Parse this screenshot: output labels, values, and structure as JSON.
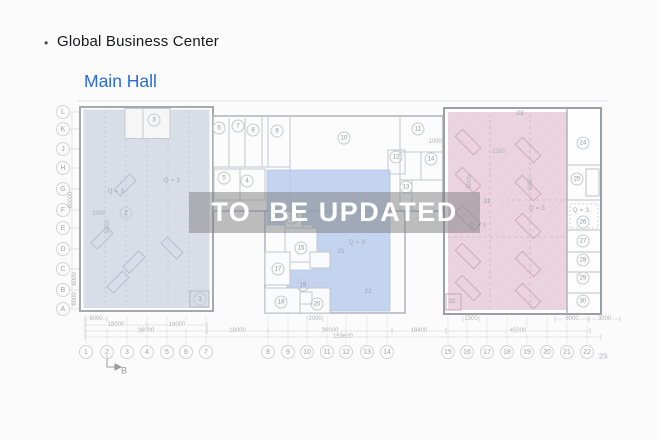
{
  "header": {
    "bullet": "•",
    "title": "Global Business Center",
    "subtitle": "Main Hall"
  },
  "watermark": "TO  BE UPDATED",
  "grid": {
    "rows": [
      {
        "label": "L",
        "y": 112
      },
      {
        "label": "K",
        "y": 129
      },
      {
        "label": "J",
        "y": 149
      },
      {
        "label": "H",
        "y": 168
      },
      {
        "label": "G",
        "y": 189
      },
      {
        "label": "F",
        "y": 210
      },
      {
        "label": "E",
        "y": 228
      },
      {
        "label": "D",
        "y": 249
      },
      {
        "label": "C",
        "y": 269
      },
      {
        "label": "B",
        "y": 290
      },
      {
        "label": "A",
        "y": 309
      }
    ],
    "cols": [
      {
        "label": "1",
        "x": 86
      },
      {
        "label": "2",
        "x": 107
      },
      {
        "label": "3",
        "x": 127
      },
      {
        "label": "4",
        "x": 147
      },
      {
        "label": "5",
        "x": 167
      },
      {
        "label": "6",
        "x": 186
      },
      {
        "label": "7",
        "x": 206
      },
      {
        "label": "8",
        "x": 268
      },
      {
        "label": "9",
        "x": 288
      },
      {
        "label": "10",
        "x": 307
      },
      {
        "label": "11",
        "x": 327
      },
      {
        "label": "12",
        "x": 346
      },
      {
        "label": "13",
        "x": 367
      },
      {
        "label": "14",
        "x": 387
      },
      {
        "label": "15",
        "x": 448
      },
      {
        "label": "16",
        "x": 467
      },
      {
        "label": "17",
        "x": 487
      },
      {
        "label": "18",
        "x": 507
      },
      {
        "label": "19",
        "x": 527
      },
      {
        "label": "20",
        "x": 547
      },
      {
        "label": "21",
        "x": 567
      },
      {
        "label": "22",
        "x": 587
      }
    ],
    "cols_y": 352,
    "col_offset": {
      "label": "23",
      "x": 603,
      "y": 356
    }
  },
  "rooms": {
    "circled": [
      {
        "n": "1",
        "x": 200,
        "y": 299
      },
      {
        "n": "2",
        "x": 126,
        "y": 213
      },
      {
        "n": "3",
        "x": 154,
        "y": 120
      },
      {
        "n": "4",
        "x": 247,
        "y": 181
      },
      {
        "n": "5",
        "x": 224,
        "y": 178
      },
      {
        "n": "6",
        "x": 219,
        "y": 128
      },
      {
        "n": "7",
        "x": 238,
        "y": 126
      },
      {
        "n": "8",
        "x": 253,
        "y": 130
      },
      {
        "n": "9",
        "x": 277,
        "y": 131
      },
      {
        "n": "10",
        "x": 344,
        "y": 138
      },
      {
        "n": "11",
        "x": 418,
        "y": 129
      },
      {
        "n": "12",
        "x": 396,
        "y": 157
      },
      {
        "n": "13",
        "x": 406,
        "y": 187
      },
      {
        "n": "14",
        "x": 431,
        "y": 159
      },
      {
        "n": "15",
        "x": 301,
        "y": 248
      },
      {
        "n": "16",
        "x": 292,
        "y": 218
      },
      {
        "n": "17",
        "x": 278,
        "y": 269
      },
      {
        "n": "18",
        "x": 281,
        "y": 302
      },
      {
        "n": "19",
        "x": 303,
        "y": 285
      },
      {
        "n": "20",
        "x": 317,
        "y": 304
      },
      {
        "n": "24",
        "x": 583,
        "y": 143
      },
      {
        "n": "25",
        "x": 577,
        "y": 179
      },
      {
        "n": "26",
        "x": 583,
        "y": 222
      },
      {
        "n": "27",
        "x": 583,
        "y": 241
      },
      {
        "n": "28",
        "x": 583,
        "y": 260
      },
      {
        "n": "29",
        "x": 583,
        "y": 278
      },
      {
        "n": "30",
        "x": 583,
        "y": 301
      }
    ],
    "plain": [
      {
        "n": "21",
        "x": 341,
        "y": 252
      },
      {
        "n": "22",
        "x": 368,
        "y": 292
      },
      {
        "n": "23",
        "x": 520,
        "y": 114
      },
      {
        "n": "31",
        "x": 487,
        "y": 202
      },
      {
        "n": "32",
        "x": 452,
        "y": 302
      }
    ]
  },
  "dimensions": {
    "horizontal": [
      {
        "label": "6000",
        "x1": 85,
        "x2": 107,
        "y": 319
      },
      {
        "label": "2000",
        "x1": 307,
        "x2": 323,
        "y": 319
      },
      {
        "label": "1300",
        "x1": 463,
        "x2": 479,
        "y": 319
      },
      {
        "label": "6000",
        "x1": 555,
        "x2": 589,
        "y": 319
      },
      {
        "label": "3000",
        "x1": 589,
        "x2": 620,
        "y": 319
      },
      {
        "label": "18000",
        "x1": 85,
        "x2": 147,
        "y": 325
      },
      {
        "label": "18000",
        "x1": 147,
        "x2": 207,
        "y": 325
      },
      {
        "label": "36000",
        "x1": 85,
        "x2": 207,
        "y": 331
      },
      {
        "label": "18000",
        "x1": 207,
        "x2": 268,
        "y": 331
      },
      {
        "label": "36000",
        "x1": 268,
        "x2": 392,
        "y": 331
      },
      {
        "label": "18400",
        "x1": 392,
        "x2": 446,
        "y": 331
      },
      {
        "label": "45000",
        "x1": 446,
        "x2": 590,
        "y": 331
      },
      {
        "label": "153600",
        "x1": 85,
        "x2": 601,
        "y": 337
      }
    ],
    "vertical": [
      {
        "label": "60000",
        "x": 71,
        "y": 200
      },
      {
        "label": "6000",
        "x": 75,
        "y": 279
      },
      {
        "label": "6000",
        "x": 75,
        "y": 299
      }
    ],
    "interior": [
      {
        "label": "2000",
        "x": 99,
        "y": 214,
        "rot": false
      },
      {
        "label": "5000",
        "x": 108,
        "y": 227,
        "rot": true
      },
      {
        "label": "1000",
        "x": 435,
        "y": 142,
        "rot": false
      },
      {
        "label": "1300",
        "x": 499,
        "y": 152,
        "rot": false
      },
      {
        "label": "6000",
        "x": 470,
        "y": 182,
        "rot": true
      },
      {
        "label": "6000",
        "x": 531,
        "y": 184,
        "rot": true
      }
    ]
  },
  "annotations": [
    {
      "label": "Q = 3",
      "x": 116,
      "y": 192
    },
    {
      "label": "Q = 3",
      "x": 172,
      "y": 181
    },
    {
      "label": "Q = 3",
      "x": 357,
      "y": 243
    },
    {
      "label": "Q = 3",
      "x": 478,
      "y": 226
    },
    {
      "label": "Q = 3",
      "x": 537,
      "y": 209
    },
    {
      "label": "Q = 3",
      "x": 581,
      "y": 211
    }
  ],
  "section_marker": {
    "label": "B",
    "x": 124,
    "y": 371
  },
  "colors": {
    "subtitle_blue": "#2a6bdb",
    "zone_gray_blue": "#cdd4e0",
    "zone_blue": "#b7cbed",
    "zone_pink": "#e9ced9",
    "watermark_band": "rgba(126,126,128,0.5)"
  }
}
